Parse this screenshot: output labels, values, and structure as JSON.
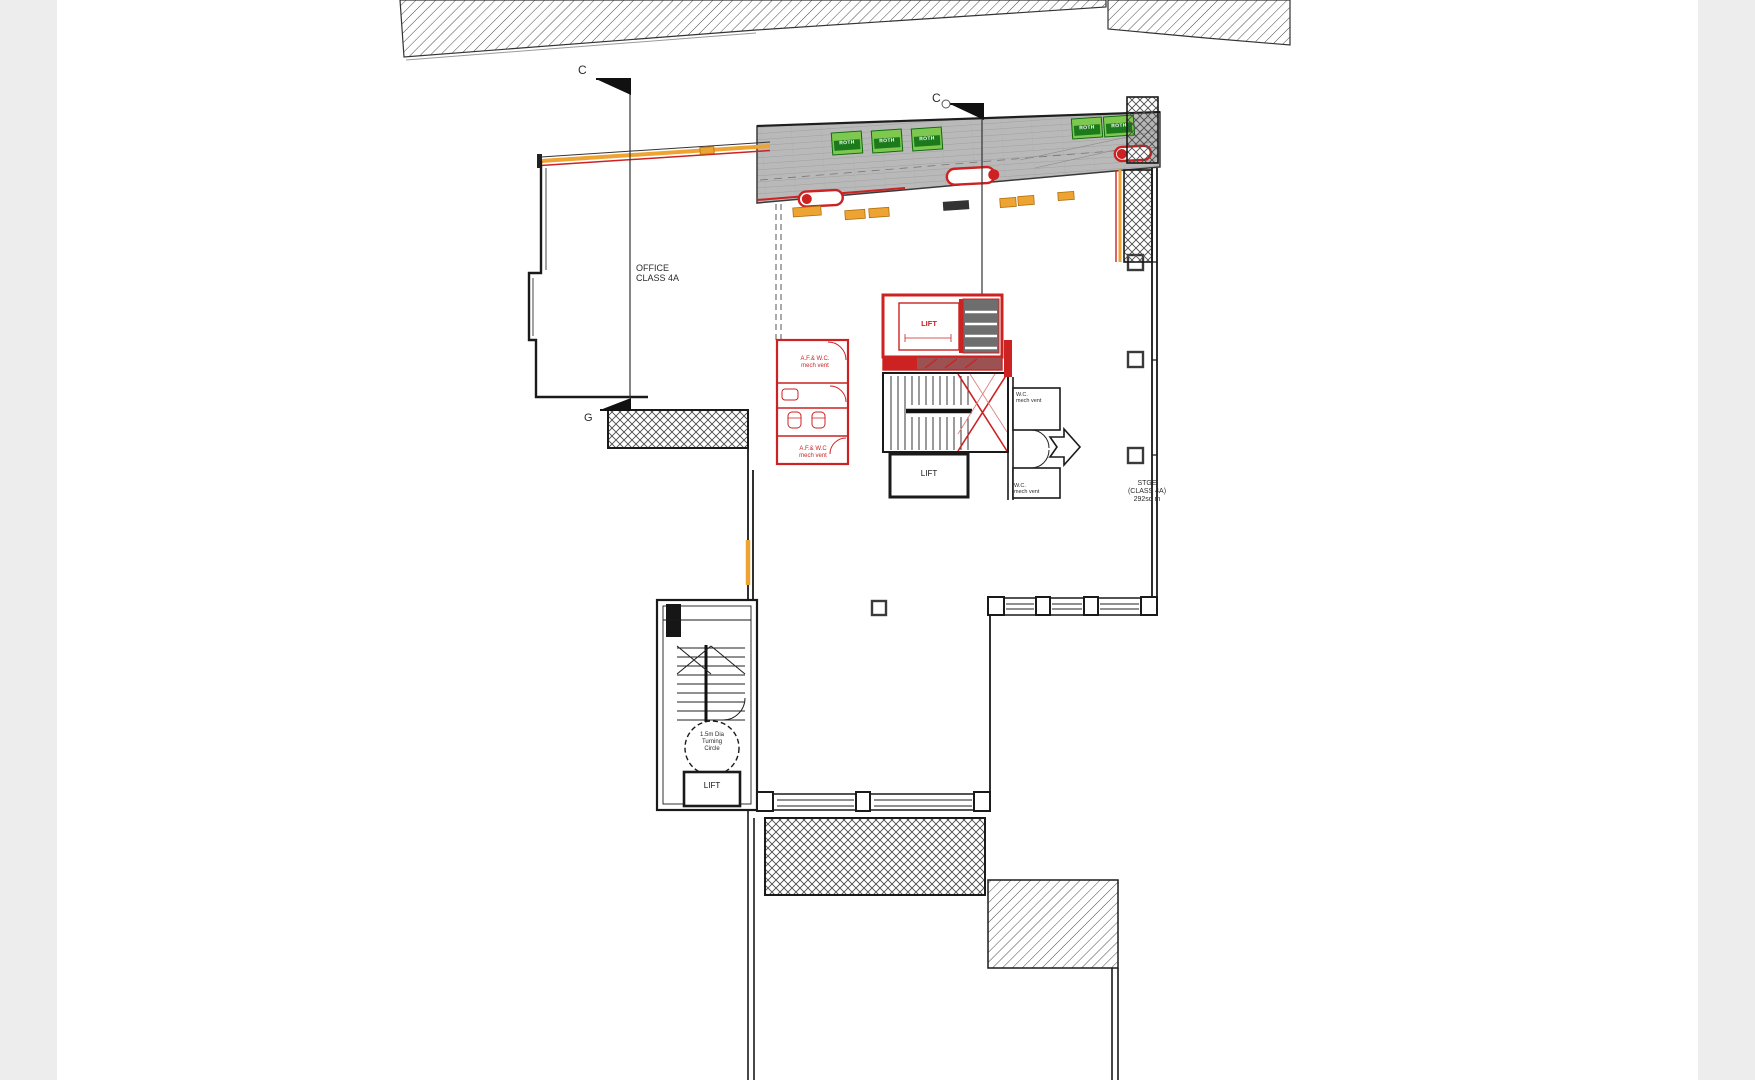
{
  "drawing": {
    "type": "architectural ground floor plan",
    "section_markers": {
      "c_left": "C",
      "c_right": "C",
      "g": "G"
    },
    "labels": {
      "office": {
        "line1": "OFFICE",
        "line2": "CLASS 4A"
      },
      "storage": {
        "line1": "STGE",
        "line2": "(CLASS 4A)",
        "line3": "292sq m"
      },
      "lift_core": "LIFT",
      "lift_lower": "LIFT",
      "lift_tower": "LIFT",
      "af_wc_upper": {
        "line1": "A.F.& W.C.",
        "line2": "mech vent"
      },
      "af_wc_lower": {
        "line1": "A.F.& W.C",
        "line2": "mech vent"
      },
      "wc_upper": {
        "line1": "W.C.",
        "line2": "mech vent"
      },
      "wc_lower": {
        "line1": "W.C.",
        "line2": "mech vent"
      },
      "turning_circle": {
        "line1": "1.5m Dia",
        "line2": "Turning",
        "line3": "Circle"
      },
      "planter": "ROTH"
    },
    "colors": {
      "new_work_red": "#cc2222",
      "window_orange": "#eda433",
      "planter_green": "#3aa52e",
      "terrace_grey": "#b9b9b9"
    }
  }
}
